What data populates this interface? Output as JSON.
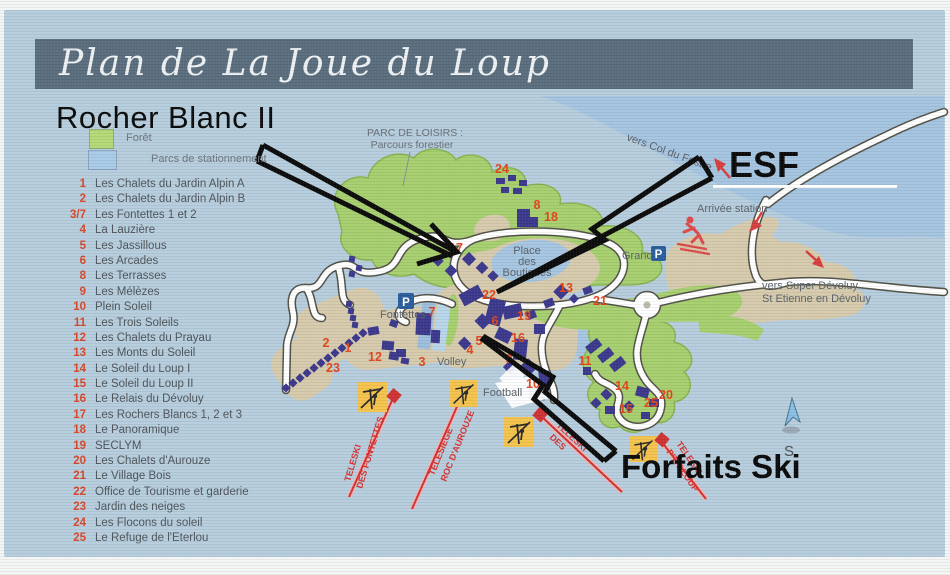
{
  "title": "Plan de La Joue du Loup",
  "annotations": {
    "rocher_blanc": "Rocher Blanc II",
    "esf": "ESF",
    "forfaits_ski": "Forfaits Ski"
  },
  "legend": {
    "forest_label": "Forêt",
    "parking_label": "Parcs de stationnement",
    "forest_color": "#b4d977",
    "parking_color": "#abcce9",
    "number_color": "#d8482a",
    "items": [
      {
        "num": "1",
        "label": "Les Chalets du Jardin Alpin A"
      },
      {
        "num": "2",
        "label": "Les Chalets du Jardin Alpin B"
      },
      {
        "num": "3/7",
        "label": "Les Fontettes 1 et 2"
      },
      {
        "num": "4",
        "label": "La Lauzière"
      },
      {
        "num": "5",
        "label": "Les Jassillous"
      },
      {
        "num": "6",
        "label": "Les Arcades"
      },
      {
        "num": "8",
        "label": "Les Terrasses"
      },
      {
        "num": "9",
        "label": "Les Mélèzes"
      },
      {
        "num": "10",
        "label": "Plein Soleil"
      },
      {
        "num": "11",
        "label": "Les Trois Soleils"
      },
      {
        "num": "12",
        "label": "Les Chalets du Prayau"
      },
      {
        "num": "13",
        "label": "Les Monts du Soleil"
      },
      {
        "num": "14",
        "label": "Le Soleil du Loup I"
      },
      {
        "num": "15",
        "label": "Le Soleil du Loup II"
      },
      {
        "num": "16",
        "label": "Le Relais du Dévoluy"
      },
      {
        "num": "17",
        "label": "Les Rochers Blancs 1, 2 et 3"
      },
      {
        "num": "18",
        "label": "Le Panoramique"
      },
      {
        "num": "19",
        "label": "SECLYM"
      },
      {
        "num": "20",
        "label": "Les Chalets d'Aurouze"
      },
      {
        "num": "21",
        "label": "Le Village Bois"
      },
      {
        "num": "22",
        "label": "Office de Tourisme et garderie"
      },
      {
        "num": "23",
        "label": "Jardin des neiges"
      },
      {
        "num": "24",
        "label": "Les Flocons du soleil"
      },
      {
        "num": "25",
        "label": "Le Refuge de l'Eterlou"
      }
    ]
  },
  "map": {
    "labels": {
      "parc_line1": "PARC DE LOISIRS :",
      "parc_line2": "Parcours forestier",
      "vers_col": "vers Col du Festre",
      "arrivee": "Arrivée station",
      "grand": "Grand",
      "p_letter": "P",
      "vers_super_1": "vers Super Dévoluy",
      "vers_super_2": "St Etienne en Dévoluy",
      "place_1": "Place",
      "place_2": "des",
      "place_3": "Boutiques",
      "fontettes": "Fontettes",
      "volley": "Volley",
      "football": "Football",
      "compass_s": "S"
    },
    "lifts": [
      {
        "name_line1": "TELESKI",
        "name_line2": "DES FONTETTES"
      },
      {
        "name_line1": "TELESIEGE",
        "name_line2": "ROC D'AUROUZE"
      },
      {
        "name_line1": "TELESKI",
        "name_line2": "DES"
      },
      {
        "name_line1": "TELESKI",
        "name_line2": "P'TIT LOUP"
      }
    ],
    "colors": {
      "background": "#b7cede",
      "water": "#a6c5e1",
      "forest": "#a8d071",
      "open_area": "#d7cbae",
      "road": "#ffffff",
      "building": "#3e3a8e",
      "lift_line": "#d03434",
      "lift_box": "#f4c44f",
      "marker": "#e2461d",
      "banner": "#5c6f7e"
    },
    "markers": [
      {
        "n": "24",
        "x": 502,
        "y": 173
      },
      {
        "n": "8",
        "x": 537,
        "y": 209
      },
      {
        "n": "18",
        "x": 551,
        "y": 221
      },
      {
        "n": "17",
        "x": 456,
        "y": 252
      },
      {
        "n": "22",
        "x": 489,
        "y": 299
      },
      {
        "n": "13",
        "x": 566,
        "y": 292
      },
      {
        "n": "21",
        "x": 600,
        "y": 305
      },
      {
        "n": "19",
        "x": 524,
        "y": 320
      },
      {
        "n": "6",
        "x": 495,
        "y": 325
      },
      {
        "n": "16",
        "x": 518,
        "y": 342
      },
      {
        "n": "5",
        "x": 479,
        "y": 345
      },
      {
        "n": "7",
        "x": 432,
        "y": 316
      },
      {
        "n": "4",
        "x": 470,
        "y": 354
      },
      {
        "n": "2",
        "x": 326,
        "y": 347
      },
      {
        "n": "1",
        "x": 348,
        "y": 352
      },
      {
        "n": "12",
        "x": 375,
        "y": 361
      },
      {
        "n": "23",
        "x": 333,
        "y": 372
      },
      {
        "n": "3",
        "x": 422,
        "y": 366
      },
      {
        "n": "9",
        "x": 509,
        "y": 363
      },
      {
        "n": "10",
        "x": 533,
        "y": 388
      },
      {
        "n": "11",
        "x": 585,
        "y": 365
      },
      {
        "n": "14",
        "x": 622,
        "y": 390
      },
      {
        "n": "15",
        "x": 626,
        "y": 413
      },
      {
        "n": "25",
        "x": 651,
        "y": 407
      },
      {
        "n": "20",
        "x": 666,
        "y": 399
      }
    ]
  }
}
